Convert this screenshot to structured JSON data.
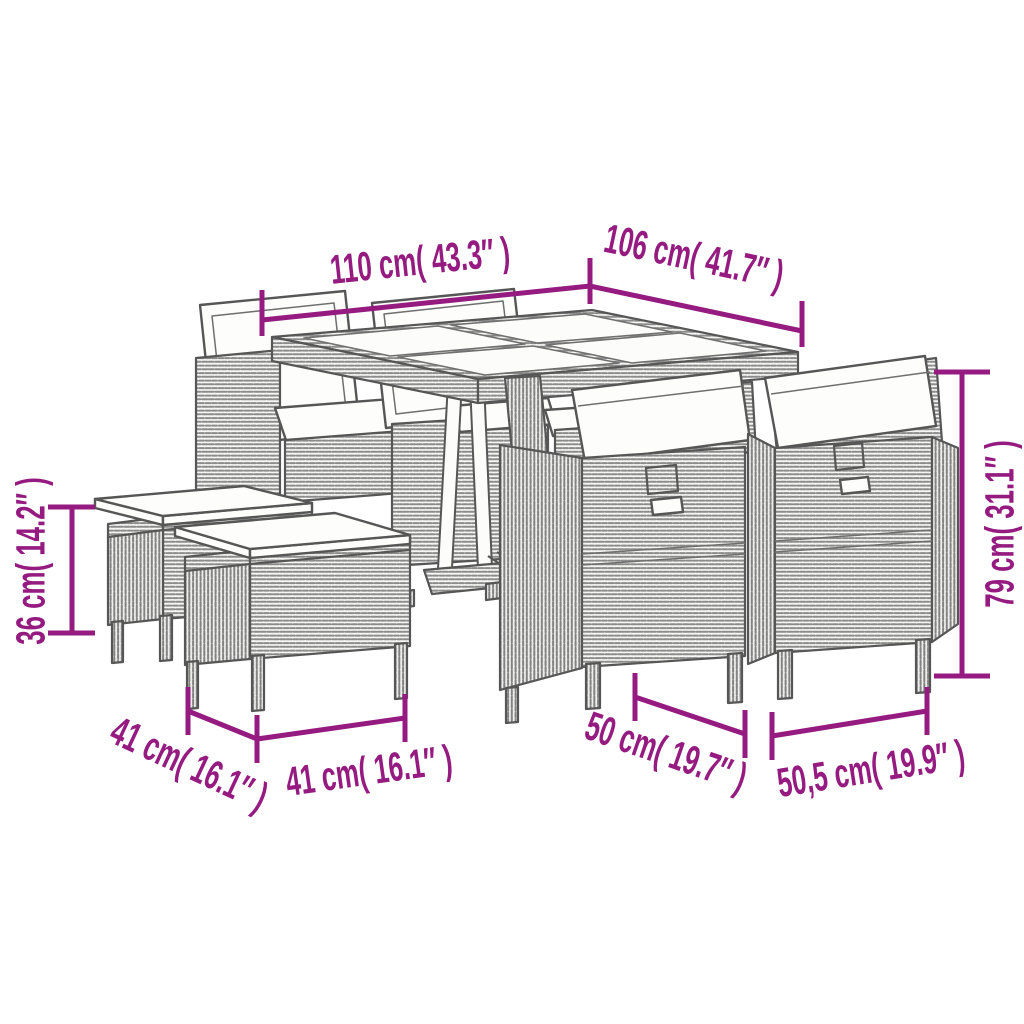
{
  "diagram": {
    "accent_color": "#951b81",
    "line_color": "#565656",
    "dimensions": {
      "table_length": "110 cm( 43.3″ )",
      "table_depth": "106 cm( 41.7″ )",
      "chair_height": "79 cm( 31.1″ )",
      "stool_height": "36 cm( 14.2″ )",
      "stool_depth": "41 cm( 16.1″ )",
      "stool_width": "41 cm( 16.1″ )",
      "chair_depth": "50 cm( 19.7″ )",
      "chair_width": "50,5 cm( 19.9″ )"
    }
  }
}
